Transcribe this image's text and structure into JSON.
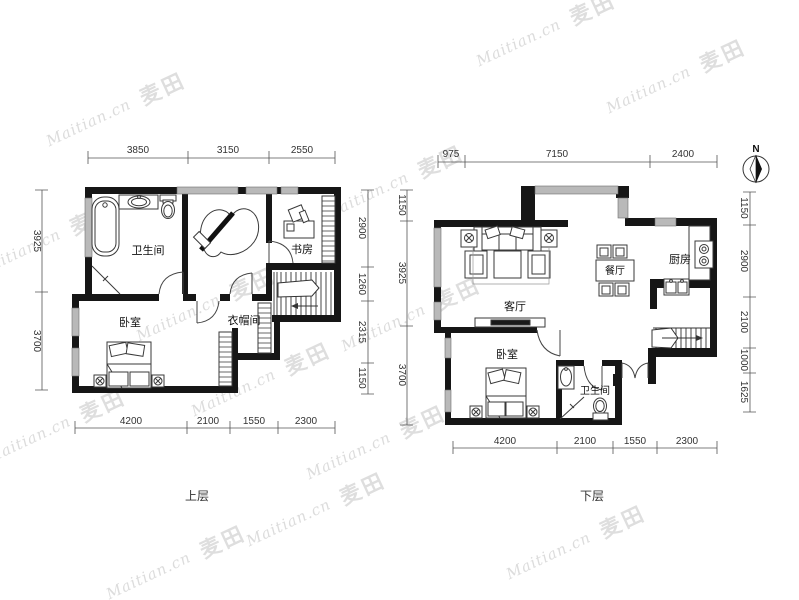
{
  "watermark": {
    "brand": "Maitian.cn",
    "logo": "麦田"
  },
  "compass": {
    "label": "N"
  },
  "upper_floor": {
    "caption": "上层",
    "rooms": {
      "bathroom": "卫生间",
      "study": "书房",
      "bedroom": "卧室",
      "cloakroom": "衣帽间"
    },
    "dims": {
      "top": [
        "3850",
        "3150",
        "2550"
      ],
      "left": [
        "3925",
        "3700"
      ],
      "right": [
        "2900",
        "1260",
        "2315",
        "1150"
      ],
      "bottom": [
        "4200",
        "2100",
        "1550",
        "2300"
      ]
    }
  },
  "lower_floor": {
    "caption": "下层",
    "rooms": {
      "living_room": "客厅",
      "dining_room": "餐厅",
      "kitchen": "厨房",
      "bedroom": "卧室",
      "bathroom": "卫生间"
    },
    "dims": {
      "top": [
        "975",
        "7150",
        "2400"
      ],
      "left": [
        "1150",
        "3925",
        "3700"
      ],
      "right": [
        "1150",
        "2900",
        "2100",
        "1000",
        "1625"
      ],
      "bottom": [
        "4200",
        "2100",
        "1550",
        "2300"
      ]
    }
  }
}
